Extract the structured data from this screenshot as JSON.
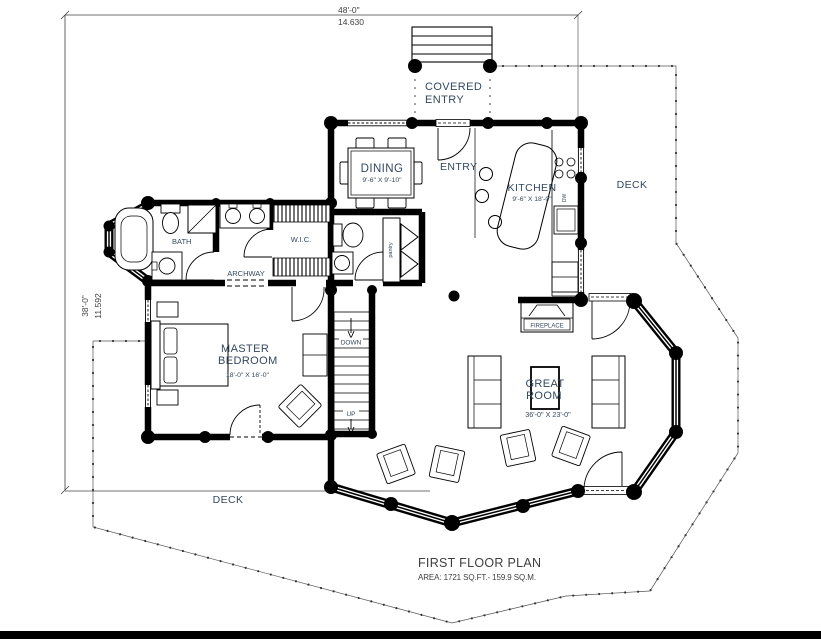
{
  "title_block": {
    "title": "FIRST FLOOR PLAN",
    "area": "AREA: 1721 SQ.FT.- 159.9 SQ.M."
  },
  "dimensions": {
    "top_feet": "48'-0\"",
    "top_meters": "14.630",
    "left_feet": "38'-0\"",
    "left_meters": "11.592"
  },
  "rooms": {
    "covered_entry_line1": "COVERED",
    "covered_entry_line2": "ENTRY",
    "entry": "ENTRY",
    "dining": "DINING",
    "dining_dims": "9'-6\" X 9'-10\"",
    "kitchen": "KITCHEN",
    "kitchen_dims": "9'-6\" X 18'-0\"",
    "deck_right": "DECK",
    "deck_bottom": "DECK",
    "bath": "BATH",
    "wic": "W.I.C.",
    "archway": "ARCHWAY",
    "pantry": "pantry",
    "dishwasher": "DW",
    "master_line1": "MASTER",
    "master_line2": "BEDROOM",
    "master_dims": "18'-0\" X 16'-0\"",
    "great_line1": "GREAT",
    "great_line2": "ROOM",
    "great_dims": "36'-0\" X 23'-0\"",
    "fireplace": "FIREPLACE",
    "stairs_down": "DOWN",
    "stairs_up": "UP"
  },
  "colors": {
    "walls": "#000000",
    "room_label": "#33485e",
    "dimension_text": "#3f3f3f",
    "background": "#ffffff"
  }
}
